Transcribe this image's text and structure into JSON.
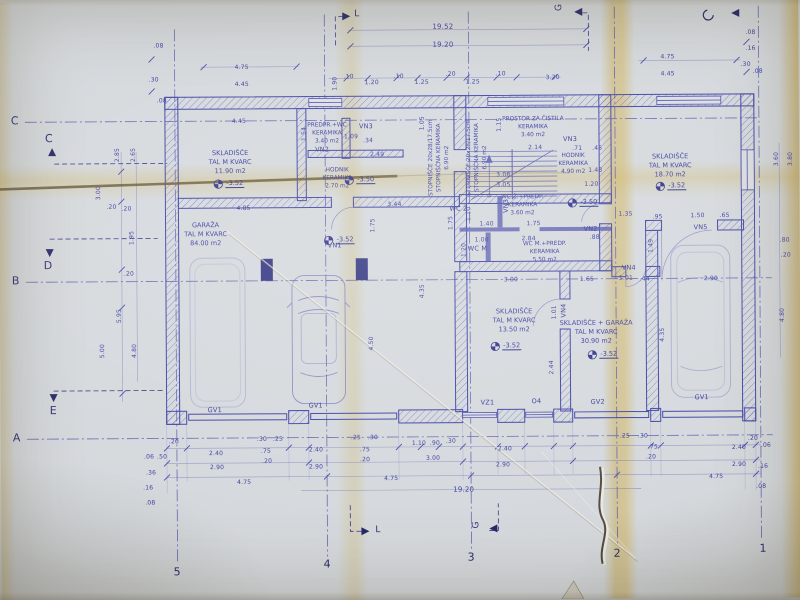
{
  "document": {
    "kind": "architectural floor plan blueprint",
    "language": "Slovenian"
  },
  "colors": {
    "ink": "#33379c",
    "ink_dark": "#1d2060",
    "paper": "#d3d7db",
    "fold_yellow": "#cda446"
  },
  "grid": {
    "rows": [
      "C",
      "B",
      "A"
    ],
    "cols": [
      "5",
      "4",
      "3",
      "2",
      "1"
    ],
    "aux": [
      "C",
      "D",
      "E"
    ]
  },
  "sections": {
    "l": "L",
    "g": "G"
  },
  "rooms": [
    {
      "name": "SKLADIŠČE",
      "floor": "TAL M KVARC",
      "area": "11.90 m2",
      "level": "-3.52"
    },
    {
      "name": "GARAŽA",
      "floor": "TAL M KVARC",
      "area": "84.00 m2",
      "level": "-3.52"
    },
    {
      "name": "PREDPR.+WC",
      "floor": "KERAMIKA",
      "area": "3.40 m2"
    },
    {
      "name": "HODNIK",
      "floor": "KERAMIKA",
      "area": "2.70 m2",
      "level": "-3.50"
    },
    {
      "name": "STOPNIŠČE 20x28/17.5cm",
      "floor": "STOPNIŠČNA KERAMIKA",
      "area": "6.90 m2"
    },
    {
      "name": "PROSTOR ZA ČISTILA",
      "floor": "KERAMIKA",
      "area": "3.40 m2"
    },
    {
      "name": "HODNIK",
      "floor": "KERAMIKA",
      "area": "4.90 m2",
      "level": "-3.50"
    },
    {
      "name": "WC Ž.+PREDP.",
      "floor": "KERAMIKA",
      "area": "3.60 m2"
    },
    {
      "name": "WC M.+PREDP.",
      "floor": "KERAMIKA",
      "area": "5.50 m2"
    },
    {
      "name": "SKLADIŠČE",
      "floor": "TAL M KVARC",
      "area": "13.50 m2",
      "level": "-3.52"
    },
    {
      "name": "SKLADIŠČE + GARAŽA",
      "floor": "TAL M KVARC",
      "area": "30.90 m2",
      "level": "-3.52"
    },
    {
      "name": "SKLADIŠČE",
      "floor": "TAL M KVARC",
      "area": "18.70 m2",
      "level": "-3.52"
    }
  ],
  "labels": {
    "wc_z": "WC Ž",
    "wc_m": "WC M"
  },
  "openings": {
    "vn1": "VN1",
    "vn2": "VN2",
    "vn3": "VN3",
    "vn4": "VN4",
    "vn5": "VN5",
    "vz1": "VZ1",
    "o4": "O4",
    "gv1": "GV1",
    "gv2": "GV2"
  },
  "dims": {
    "totals": [
      "19.52",
      "19.20",
      "19.20"
    ],
    "top": [
      "4.75",
      "4.45",
      "1.90",
      ".10",
      "1.20",
      ".10",
      "1.25",
      ".20",
      "1.25",
      ".10",
      "3.20",
      "4.75",
      "4.45",
      ".08",
      ".16",
      ".30",
      ".08",
      ".08",
      ".30",
      ".08"
    ],
    "left": [
      "2.85",
      "2.65",
      "3.00",
      ".20",
      ".20",
      "1.95",
      ".20",
      "5.95",
      "5.00",
      "4.80"
    ],
    "right": [
      "3.60",
      "3.80",
      ".80",
      ".20",
      "4.80"
    ],
    "bottom": [
      ".20",
      ".30",
      ".25",
      "2.40",
      ".75",
      ".20",
      "2.90",
      "4.75",
      ".25",
      ".30",
      "2.40",
      ".75",
      ".20",
      "2.90",
      "4.75",
      "1.10",
      ".90",
      ".30",
      "3.00",
      "2.40",
      "2.90",
      ".25",
      ".30",
      ".75",
      ".20",
      "2.40",
      "2.90",
      "4.75",
      ".20",
      ".06",
      ".16",
      ".08",
      ".06",
      ".50",
      ".36",
      ".16",
      ".08"
    ],
    "interior": [
      "4.45",
      "1.05",
      "1.15",
      "1.54",
      "1.09",
      ".34",
      "2.49",
      "2.14",
      ".71",
      ".45",
      "3.08",
      "3.05",
      "1.48",
      "1.20",
      "4.85",
      "3.44",
      "1.75",
      "1.75",
      "1.10",
      "1.40",
      "1.75",
      "2.84",
      "1.00",
      "1.20",
      "3.00",
      "1.65",
      "1.01",
      ".44",
      "1.35",
      ".95",
      "1.50",
      ".65",
      "2.90",
      "4.35",
      "4.50",
      "2.44",
      "1.01",
      "4.35",
      "1.49",
      ".88"
    ]
  }
}
